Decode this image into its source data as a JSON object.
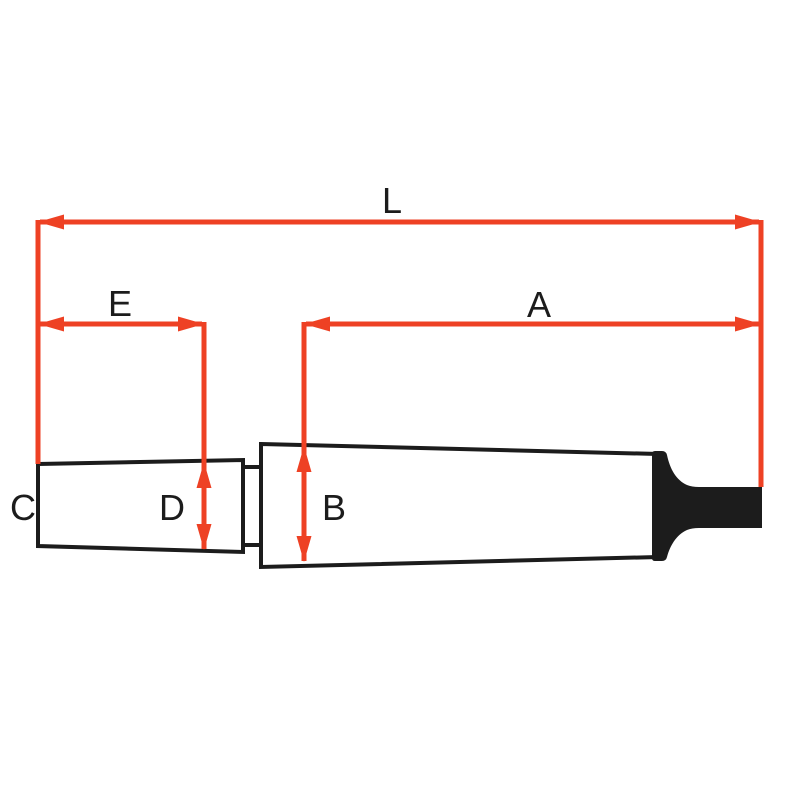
{
  "diagram": {
    "type": "technical-dimension-drawing",
    "subject": "drill chuck arbor with morse taper shank and tang",
    "labels": {
      "overall_length": "L",
      "chuck_taper_length": "E",
      "shank_taper_length": "A",
      "small_end": "C",
      "chuck_end_diameter": "D",
      "shank_diameter": "B"
    },
    "colors": {
      "dimension_red": "#EE4124",
      "outline_black": "#1C1C1C",
      "background": "#FFFFFF"
    }
  }
}
